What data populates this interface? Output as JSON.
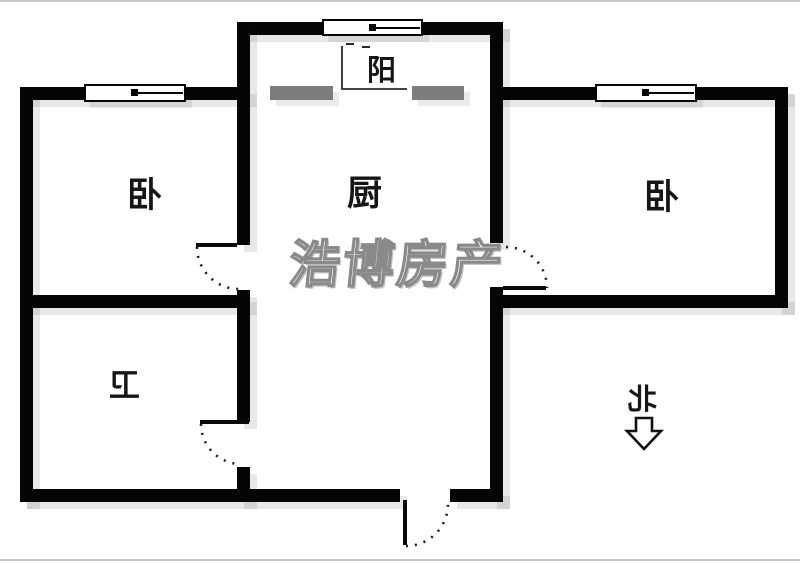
{
  "title": "apartment floor plan",
  "watermark": {
    "text": "浩博房产",
    "color": "#8a8a8a"
  },
  "rooms": [
    {
      "id": "balcony",
      "label": "阳",
      "mirrored": false
    },
    {
      "id": "kitchen",
      "label": "厨",
      "mirrored": false
    },
    {
      "id": "bedroom-left",
      "label": "卧",
      "mirrored": false
    },
    {
      "id": "bedroom-right",
      "label": "卧",
      "mirrored": false
    },
    {
      "id": "bathroom",
      "label": "卫",
      "mirrored": true
    }
  ],
  "compass": {
    "label": "北",
    "arrow_direction": "down",
    "mirrored": true
  },
  "features": {
    "windows": [
      "bedroom-left-window",
      "balcony-window",
      "bedroom-right-window"
    ],
    "doors": [
      "bedroom-left-door",
      "bedroom-right-door",
      "bathroom-door",
      "entry-door"
    ],
    "balcony_openings": 2
  },
  "colors": {
    "wall": "#050505",
    "balcony_opening_gray": "#7d7d7d",
    "watermark_gray": "#8a8a8a",
    "background": "#ffffff",
    "shadow": "rgba(0,0,0,0.09)"
  }
}
